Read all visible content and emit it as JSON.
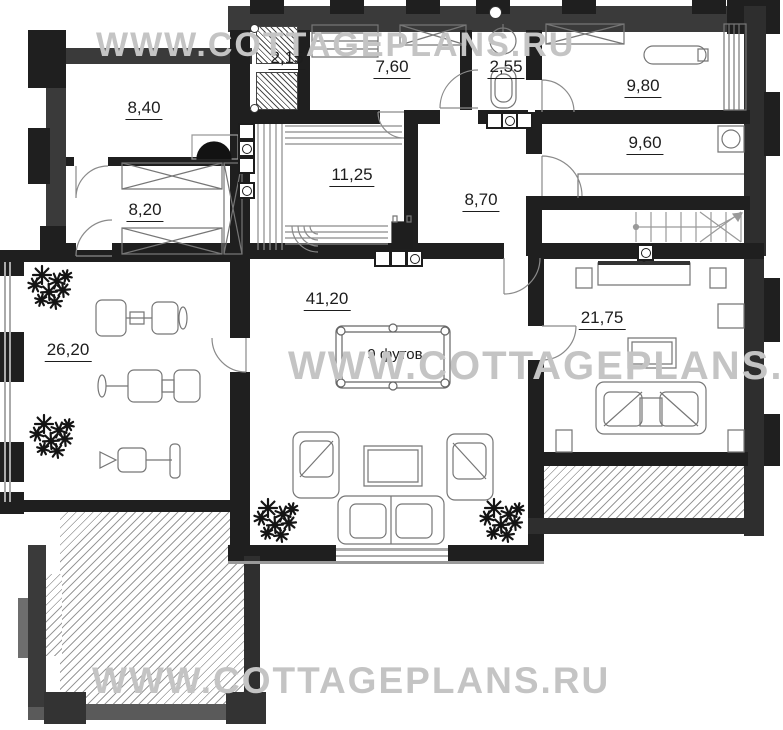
{
  "watermark": {
    "text": "WWW.COTTAGEPLANS.RU"
  },
  "billiard_table": {
    "label": "9 футов"
  },
  "rooms": {
    "r215": {
      "area": "2,15"
    },
    "r760": {
      "area": "7,60"
    },
    "r255": {
      "area": "2,55"
    },
    "r980": {
      "area": "9,80"
    },
    "r840": {
      "area": "8,40"
    },
    "r960": {
      "area": "9,60"
    },
    "r1125": {
      "area": "11,25"
    },
    "r870": {
      "area": "8,70"
    },
    "r820": {
      "area": "8,20"
    },
    "r4120": {
      "area": "41,20"
    },
    "r2620": {
      "area": "26,20"
    },
    "r2175": {
      "area": "21,75"
    }
  }
}
